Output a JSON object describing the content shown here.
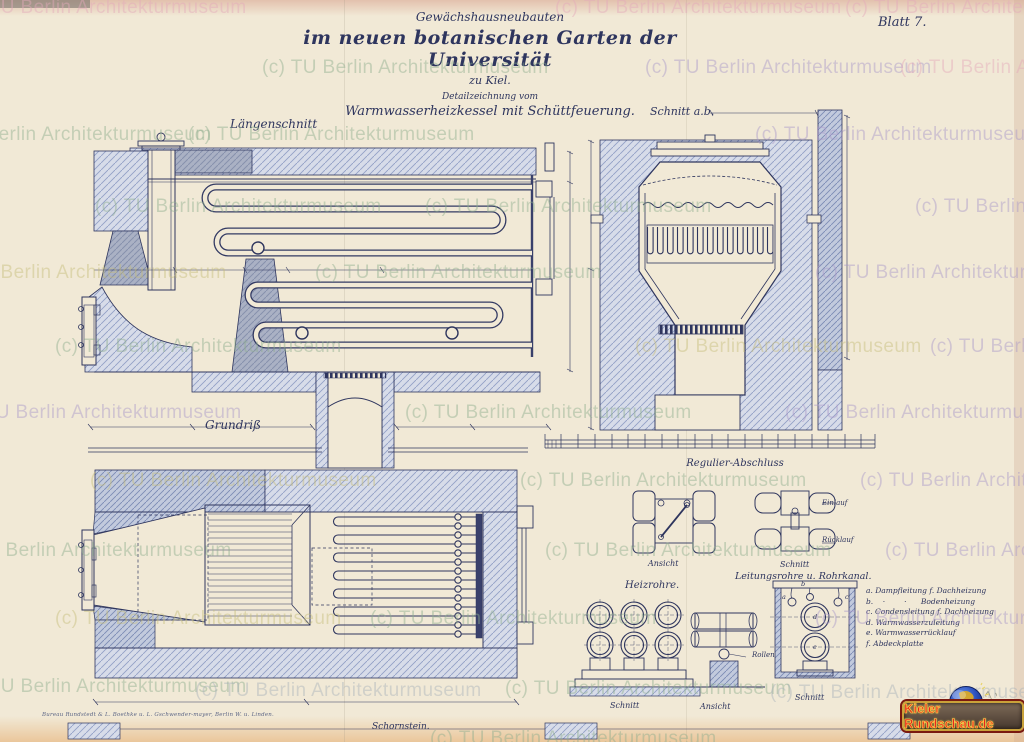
{
  "page": {
    "watermark_text": "(c) TU Berlin Architekturmuseum",
    "sheet_label": "Blatt 7."
  },
  "title_block": {
    "line1": "Gewächshausneubauten",
    "line2": "im neuen botanischen Garten der Universität",
    "line3": "zu Kiel.",
    "line4": "Detailzeichnung vom",
    "line5": "Warmwasserheizkessel mit Schüttfeuerung."
  },
  "sections": {
    "laengenschnitt": "Längenschnitt",
    "schnitt_ab": "Schnitt a.b.",
    "grundriss": "Grundriß",
    "massstab": "Maßstab 1:10.",
    "regulier": {
      "title": "Regulier-Abschluss",
      "ansicht": "Ansicht",
      "schnitt": "Schnitt",
      "einlauf": "Einlauf",
      "ruecklauf": "Rücklauf"
    },
    "leitungsrohre": "Leitungsrohre u. Rohrkanal.",
    "heizrohre": {
      "title": "Heizrohre.",
      "schnitt": "Schnitt",
      "ansicht": "Ansicht",
      "rollen": "Rollen",
      "kanal_schnitt": "Schnitt",
      "pipe_letters": [
        "a",
        "b",
        "c",
        "d",
        "e"
      ]
    },
    "schornstein": "Schornstein."
  },
  "legend": {
    "items": [
      "a. Dampfleitung f. Dachheizung",
      "b.    ·        ·      Bodenheizung",
      "c. Condensleitung f. Dachheizung",
      "d. Warmwasserzuleitung",
      "e. Warmwasserrücklauf",
      "f. Abdeckplatte"
    ]
  },
  "footer": {
    "signature": "Bureau Rundstedt & L. Boethke u. L. Gschwender-mayer, Berlin W. u. Linden.",
    "badge": "Kieler Rundschau.de",
    "pencil_note_1": "7,",
    "pencil_note_2": "28"
  }
}
